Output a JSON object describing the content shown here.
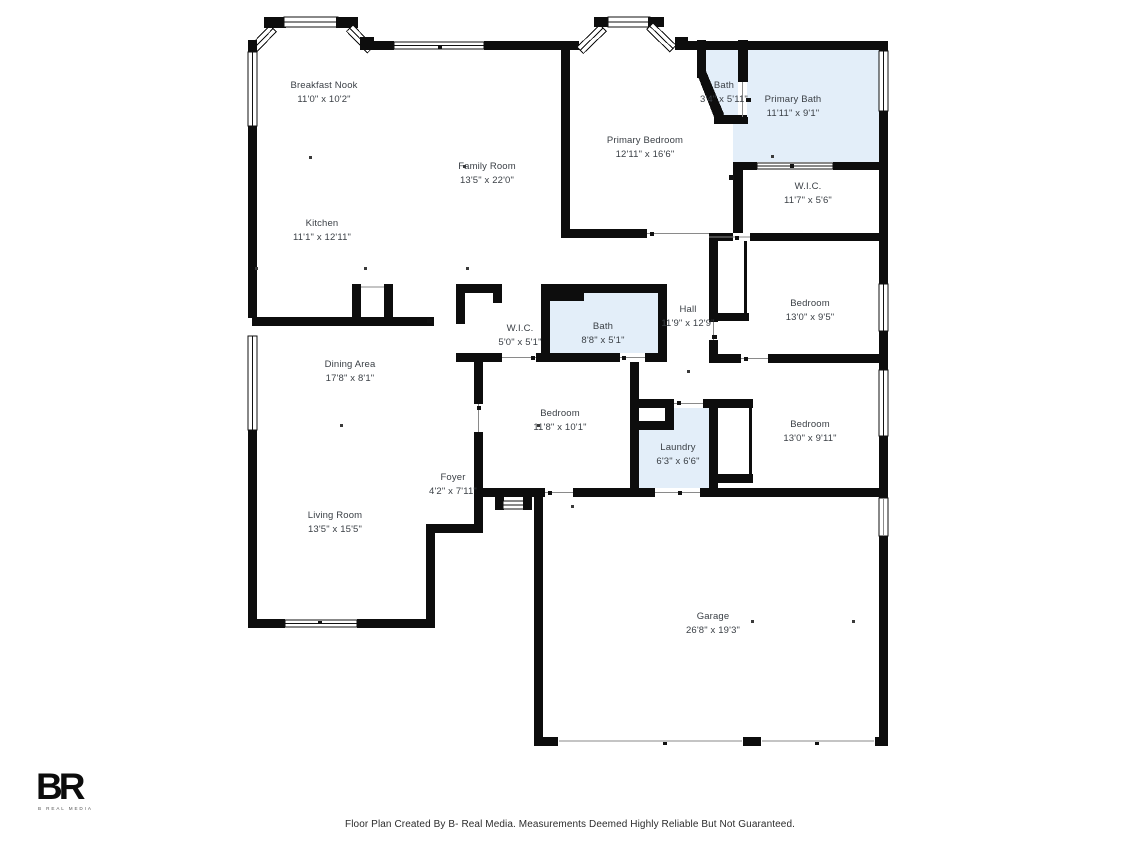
{
  "colors": {
    "wall": "#0d0d0d",
    "room_fill": "#e3eef9",
    "label_text": "#3b4046"
  },
  "rooms": [
    {
      "name": "Breakfast Nook",
      "dims": "11'0\" x 10'2\""
    },
    {
      "name": "Family Room",
      "dims": "13'5\" x 22'0\""
    },
    {
      "name": "Kitchen",
      "dims": "11'1\" x 12'11\""
    },
    {
      "name": "Primary Bedroom",
      "dims": "12'11\" x 16'6\""
    },
    {
      "name": "Bath",
      "dims": "3'4\" x 5'11\""
    },
    {
      "name": "Primary Bath",
      "dims": "11'11\" x 9'1\""
    },
    {
      "name": "W.I.C.",
      "dims": "11'7\" x 5'6\""
    },
    {
      "name": "Bedroom",
      "dims": "13'0\" x 9'5\""
    },
    {
      "name": "Hall",
      "dims": "11'9\" x 12'9\""
    },
    {
      "name": "W.I.C.",
      "dims": "5'0\" x 5'1\""
    },
    {
      "name": "Bath",
      "dims": "8'8\" x 5'1\""
    },
    {
      "name": "Dining Area",
      "dims": "17'8\" x 8'1\""
    },
    {
      "name": "Bedroom",
      "dims": "11'8\" x 10'1\""
    },
    {
      "name": "Laundry",
      "dims": "6'3\" x 6'6\""
    },
    {
      "name": "Bedroom",
      "dims": "13'0\" x 9'11\""
    },
    {
      "name": "Foyer",
      "dims": "4'2\" x 7'11\""
    },
    {
      "name": "Living Room",
      "dims": "13'5\" x 15'5\""
    },
    {
      "name": "Garage",
      "dims": "26'8\" x 19'3\""
    }
  ],
  "footer": {
    "text": "Floor Plan Created By B- Real Media. Measurements Deemed Highly Reliable But Not Guaranteed."
  },
  "logo": {
    "mark": "BR",
    "subtext": "B REAL MEDIA"
  }
}
